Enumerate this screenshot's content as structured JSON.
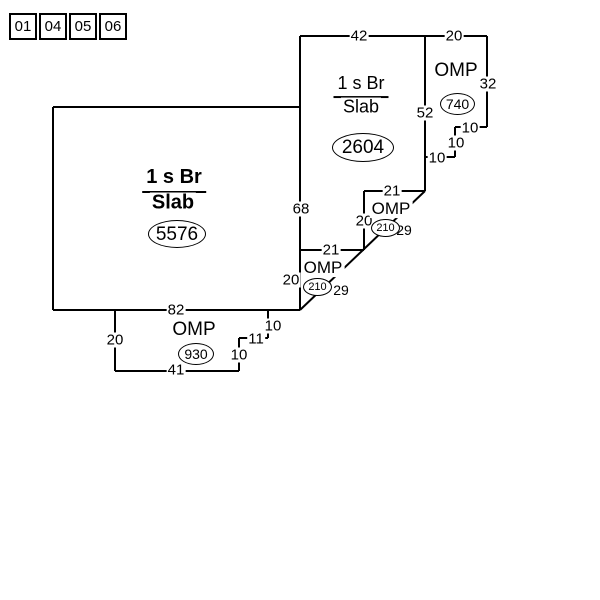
{
  "page_tabs": [
    {
      "label": "01"
    },
    {
      "label": "04"
    },
    {
      "label": "05"
    },
    {
      "label": "06"
    }
  ],
  "colors": {
    "line": "#000000",
    "background": "#ffffff"
  },
  "sections": {
    "main": {
      "story": "1 s Br",
      "foundation": "Slab",
      "area": "5576"
    },
    "upper": {
      "story": "1 s Br",
      "foundation": "Slab",
      "area": "2604"
    },
    "porch_right": {
      "label": "OMP",
      "area": "740"
    },
    "porch_step_upper": {
      "label": "OMP",
      "area": "210"
    },
    "porch_step_lower": {
      "label": "OMP",
      "area": "210"
    },
    "porch_bottom": {
      "label": "OMP",
      "area": "930"
    }
  },
  "dimensions": {
    "top_42": "42",
    "top_20": "20",
    "right_32": "32",
    "step_r1": "10",
    "step_r2": "10",
    "step_r3": "10",
    "mid_52": "52",
    "upper_21": "21",
    "upper_20": "20",
    "upper_29": "29",
    "lower_21": "21",
    "lower_20": "20",
    "lower_29": "29",
    "main_68": "68",
    "main_82": "82",
    "bottom_20": "20",
    "bottom_41": "41",
    "bottom_10a": "10",
    "bottom_11": "11",
    "bottom_10b": "10"
  }
}
